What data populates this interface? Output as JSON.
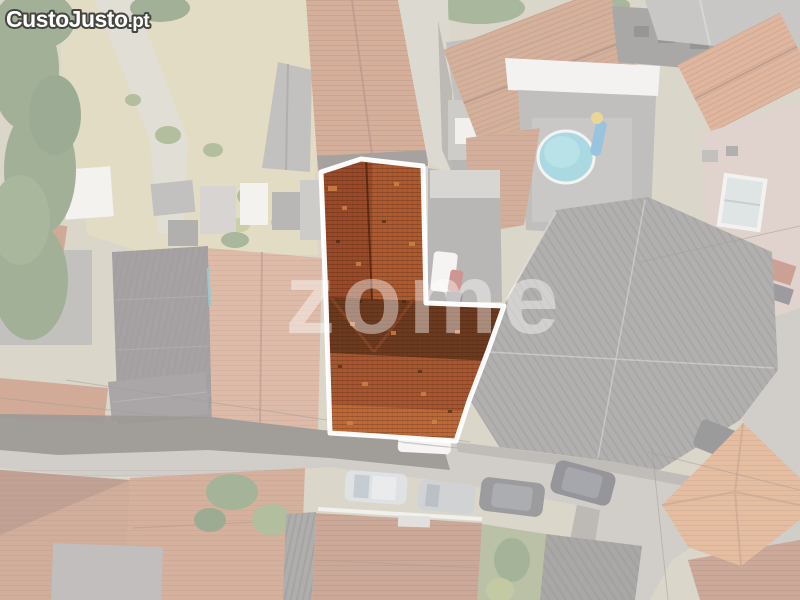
{
  "branding": {
    "logo_main": "CustoJusto",
    "logo_tld": ".pt",
    "logo_fill": "#ffffff",
    "logo_outline": "#45463f"
  },
  "watermark": {
    "text": "zome",
    "color": "#ffffff"
  },
  "photo": {
    "type": "aerial-drone-view-of-village-rooftops",
    "highlight": {
      "outline_color": "#ffffff",
      "outline_points": "321,172 361,159 423,166 426,303 504,306 488,351 469,401 456,441 330,433 326,300",
      "roof_base_color": "#a5532c"
    },
    "palette": {
      "wash_overlay": "#ffffff",
      "washed_terracotta": "#b66a44",
      "slate_roof": "#585054",
      "road": "#a8a39c",
      "road_shadow": "#453e37",
      "pool_water": "#5fb7c8",
      "vegetation": "#4f6a3c",
      "dry_garden": "#c9bd92",
      "bright_hip_roof": "#cf824f",
      "corrugated_roof": "#6f6b67"
    }
  }
}
